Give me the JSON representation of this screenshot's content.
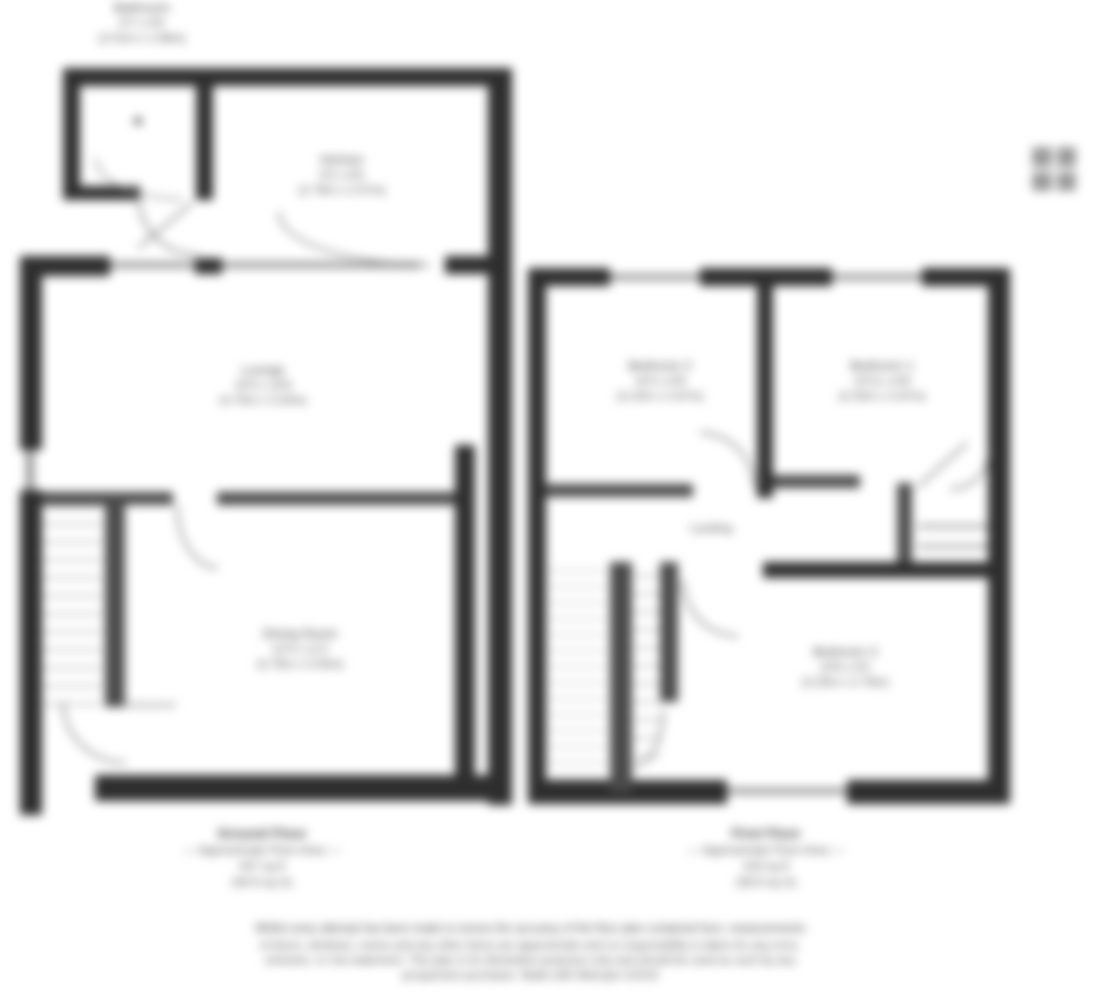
{
  "plan": {
    "brand": {
      "logo_name": "Metropix"
    },
    "bathroom_label": {
      "name": "Bathroom",
      "dims_imperial": "6'7 x 5'6",
      "dims_metric": "(2.01m x 1.68m)"
    },
    "ground_floor": {
      "rooms": [
        {
          "name": "Kitchen",
          "dims_imperial": "9'2 x 8'5",
          "dims_metric": "(2.79m x 2.57m)"
        },
        {
          "name": "Lounge",
          "dims_imperial": "15'5 x 10'6",
          "dims_metric": "(4.70m x 3.20m)"
        },
        {
          "name": "Dining Room",
          "dims_imperial": "12'4 x 11'2",
          "dims_metric": "(3.76m x 3.40m)"
        }
      ],
      "caption": {
        "title": "Ground Floor",
        "line2": "— Approximate Floor Area —",
        "line3": "437 sq ft",
        "line4": "(40.6 sq m)"
      }
    },
    "first_floor": {
      "rooms": [
        {
          "name": "Bedroom 2",
          "dims_imperial": "10'2 x 8'9",
          "dims_metric": "(3.10m x 2.67m)"
        },
        {
          "name": "Bedroom 1",
          "dims_imperial": "10'11 x 8'9",
          "dims_metric": "(3.33m x 2.67m)"
        },
        {
          "name": "Bedroom 3",
          "dims_imperial": "10'6 x 9'2",
          "dims_metric": "(3.20m x 2.79m)"
        },
        {
          "name": "Landing"
        }
      ],
      "caption": {
        "title": "First Floor",
        "line2": "— Approximate Floor Area —",
        "line3": "419 sq ft",
        "line4": "(38.9 sq m)"
      }
    },
    "footer": {
      "line1": "Whilst every attempt has been made to ensure the accuracy of the floor plan contained here, measurements",
      "line2": "of doors, windows, rooms and any other items are approximate and no responsibility is taken for any error,",
      "line3": "omission, or mis-statement. This plan is for illustrative purposes only and should be used as such by any",
      "line4": "prospective purchaser. Made with Metropix ©2019"
    }
  }
}
